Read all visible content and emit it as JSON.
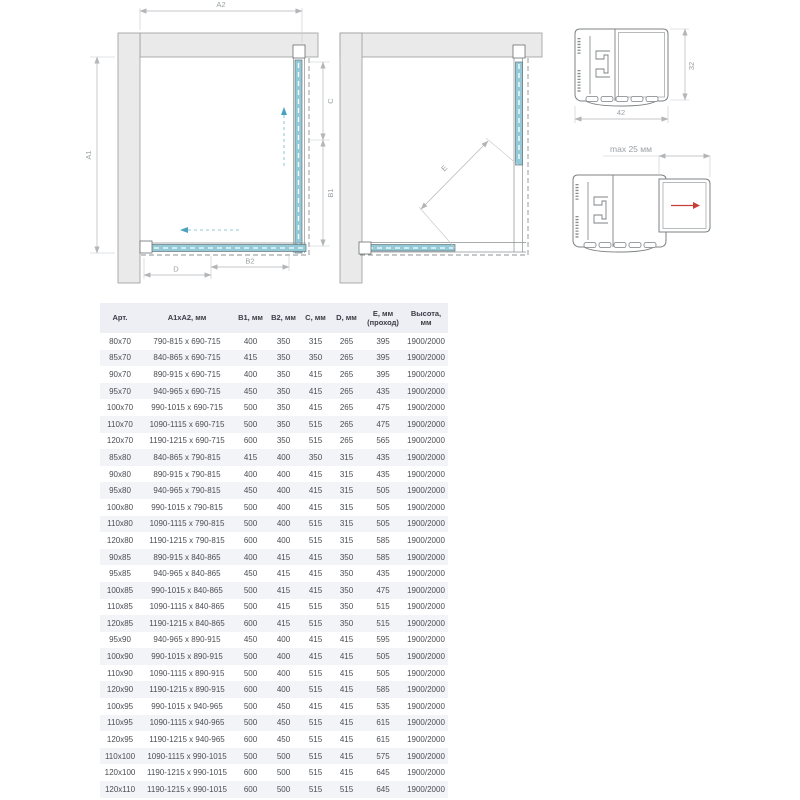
{
  "diagrams": {
    "closed": {
      "name": "corner enclosure plan view, doors closed",
      "labels": {
        "a1": "A1",
        "a2": "A2",
        "b1": "B1",
        "b2": "B2",
        "c": "C",
        "d": "D"
      }
    },
    "open": {
      "name": "corner enclosure plan view, doors open",
      "labels": {
        "e": "E"
      }
    },
    "profile_top": {
      "width": "42",
      "height": "32"
    },
    "profile_bottom": {
      "max_adjust": "max 25 мм"
    }
  },
  "colors": {
    "glass": "#93cad7",
    "wall_fill": "#eaeaea",
    "outline": "#7c8083",
    "dimension": "#b3b5b7",
    "accent_red": "#c24038",
    "table_header_bg": "#edeff4",
    "table_row_alt_bg": "#f3f4f8"
  },
  "table": {
    "headers": [
      "Арт.",
      "А1хА2, мм",
      "В1, мм",
      "В2, мм",
      "С, мм",
      "D, мм",
      "Е, мм (проход)",
      "Высота, мм"
    ],
    "rows": [
      [
        "80x70",
        "790-815 x 690-715",
        "400",
        "350",
        "315",
        "265",
        "395",
        "1900/2000"
      ],
      [
        "85x70",
        "840-865 x 690-715",
        "415",
        "350",
        "350",
        "265",
        "395",
        "1900/2000"
      ],
      [
        "90x70",
        "890-915 x 690-715",
        "400",
        "350",
        "415",
        "265",
        "395",
        "1900/2000"
      ],
      [
        "95x70",
        "940-965 x 690-715",
        "450",
        "350",
        "415",
        "265",
        "435",
        "1900/2000"
      ],
      [
        "100x70",
        "990-1015 x 690-715",
        "500",
        "350",
        "415",
        "265",
        "475",
        "1900/2000"
      ],
      [
        "110x70",
        "1090-1115 x 690-715",
        "500",
        "350",
        "515",
        "265",
        "475",
        "1900/2000"
      ],
      [
        "120x70",
        "1190-1215 x 690-715",
        "600",
        "350",
        "515",
        "265",
        "565",
        "1900/2000"
      ],
      [
        "85x80",
        "840-865 x 790-815",
        "415",
        "400",
        "350",
        "315",
        "435",
        "1900/2000"
      ],
      [
        "90x80",
        "890-915 x 790-815",
        "400",
        "400",
        "415",
        "315",
        "435",
        "1900/2000"
      ],
      [
        "95x80",
        "940-965 x 790-815",
        "450",
        "400",
        "415",
        "315",
        "505",
        "1900/2000"
      ],
      [
        "100x80",
        "990-1015 x 790-815",
        "500",
        "400",
        "415",
        "315",
        "505",
        "1900/2000"
      ],
      [
        "110x80",
        "1090-1115 x 790-815",
        "500",
        "400",
        "515",
        "315",
        "505",
        "1900/2000"
      ],
      [
        "120x80",
        "1190-1215 x 790-815",
        "600",
        "400",
        "515",
        "315",
        "585",
        "1900/2000"
      ],
      [
        "90x85",
        "890-915 x 840-865",
        "400",
        "415",
        "415",
        "350",
        "585",
        "1900/2000"
      ],
      [
        "95x85",
        "940-965 x 840-865",
        "450",
        "415",
        "415",
        "350",
        "435",
        "1900/2000"
      ],
      [
        "100x85",
        "990-1015 x 840-865",
        "500",
        "415",
        "415",
        "350",
        "475",
        "1900/2000"
      ],
      [
        "110x85",
        "1090-1115 x 840-865",
        "500",
        "415",
        "515",
        "350",
        "515",
        "1900/2000"
      ],
      [
        "120x85",
        "1190-1215 x 840-865",
        "600",
        "415",
        "515",
        "350",
        "515",
        "1900/2000"
      ],
      [
        "95x90",
        "940-965 x 890-915",
        "450",
        "400",
        "415",
        "415",
        "595",
        "1900/2000"
      ],
      [
        "100x90",
        "990-1015 x 890-915",
        "500",
        "400",
        "415",
        "415",
        "505",
        "1900/2000"
      ],
      [
        "110x90",
        "1090-1115 x 890-915",
        "500",
        "400",
        "515",
        "415",
        "505",
        "1900/2000"
      ],
      [
        "120x90",
        "1190-1215 x 890-915",
        "600",
        "400",
        "515",
        "415",
        "585",
        "1900/2000"
      ],
      [
        "100x95",
        "990-1015 x 940-965",
        "500",
        "450",
        "415",
        "415",
        "535",
        "1900/2000"
      ],
      [
        "110x95",
        "1090-1115 x 940-965",
        "500",
        "450",
        "515",
        "415",
        "615",
        "1900/2000"
      ],
      [
        "120x95",
        "1190-1215 x 940-965",
        "600",
        "450",
        "515",
        "415",
        "615",
        "1900/2000"
      ],
      [
        "110x100",
        "1090-1115 x 990-1015",
        "500",
        "500",
        "515",
        "415",
        "575",
        "1900/2000"
      ],
      [
        "120x100",
        "1190-1215 x 990-1015",
        "600",
        "500",
        "515",
        "415",
        "645",
        "1900/2000"
      ],
      [
        "120x110",
        "1190-1215 x 990-1015",
        "600",
        "500",
        "515",
        "515",
        "645",
        "1900/2000"
      ]
    ]
  }
}
